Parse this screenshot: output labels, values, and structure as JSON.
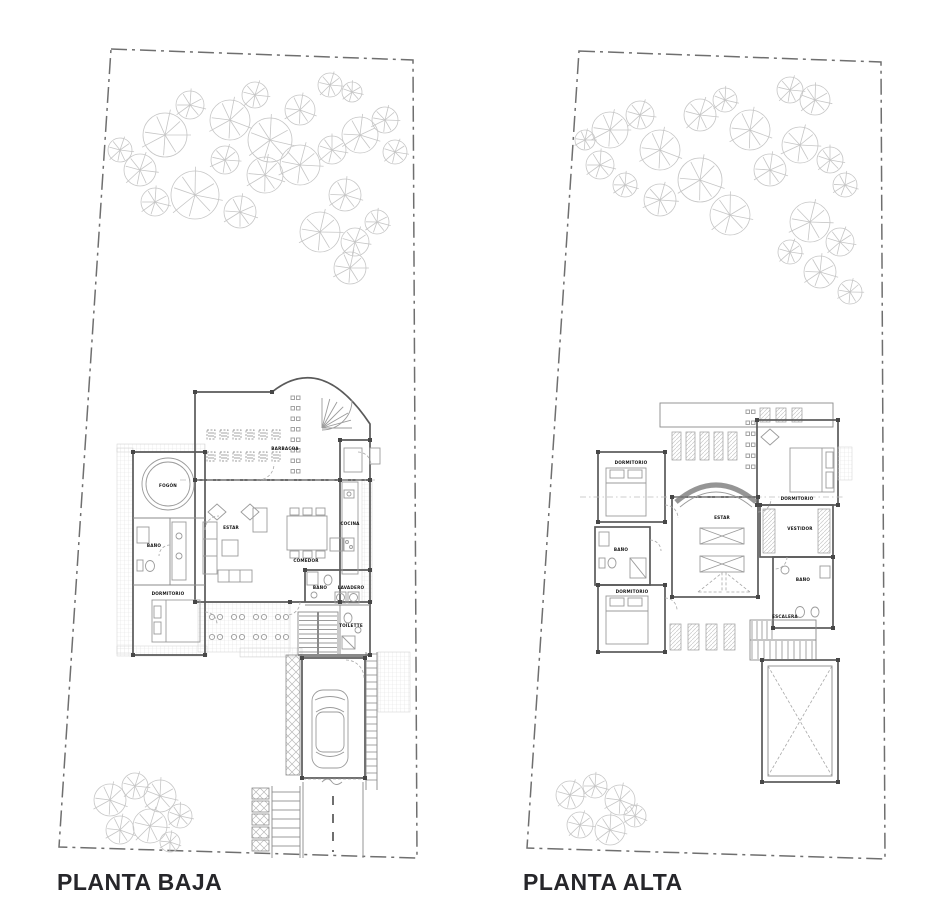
{
  "page": {
    "background": "#ffffff"
  },
  "colors": {
    "wall": "#5a5a5a",
    "furniture": "#9b9b9b",
    "hatch": "#dcdcdc",
    "tree": "#c6c6c6",
    "boundary": "#6f6f6f",
    "label": "#141414",
    "caption": "#26262a"
  },
  "plans": {
    "planta_baja": {
      "caption": "PLANTA BAJA",
      "rooms": {
        "barbacoa": "BARBACOA",
        "estar": "ESTAR",
        "comedor": "COMEDOR",
        "cocina": "COCINA",
        "fogon": "FOGÓN",
        "bano": "BAÑO",
        "dormitorio": "DORMITORIO",
        "bano_se": "BAÑO",
        "lavadero": "LAVADERO",
        "toilette": "TOILETTE"
      }
    },
    "planta_alta": {
      "caption": "PLANTA ALTA",
      "rooms": {
        "dormitorio_1": "DORMITORIO",
        "dormitorio_ppal": "DORMITORIO",
        "estar": "ESTAR",
        "vestidor": "VESTIDOR",
        "bano_1": "BAÑO",
        "bano_2": "BAÑO",
        "dormitorio_2": "DORMITORIO",
        "escalera": "ESCALERA"
      }
    }
  }
}
